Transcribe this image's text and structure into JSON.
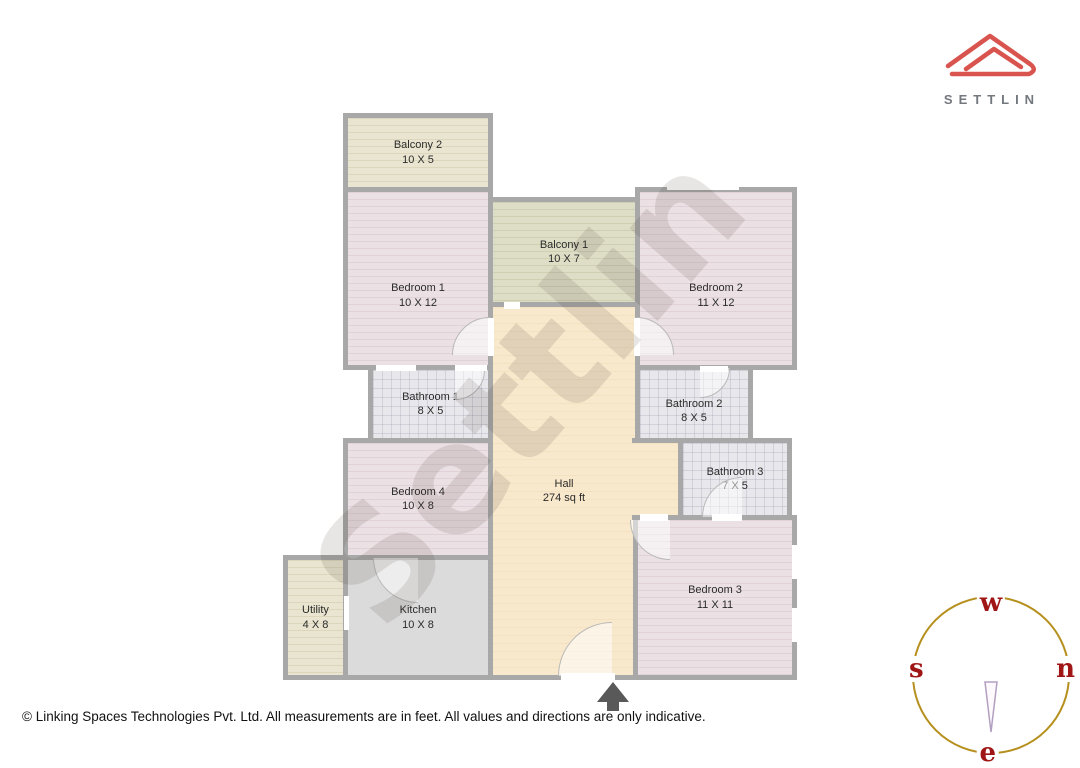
{
  "logo": {
    "brand": "SETTLIN",
    "accent_color": "#d9544e",
    "text_color": "#73787f"
  },
  "watermark": {
    "text": "Settlin"
  },
  "floorplan": {
    "colors": {
      "wall": "#a8a8a8",
      "bedroom_fill": "#ebe0e4",
      "bathroom_fill": "#e8e8ec",
      "hall_fill": "#f8e8cc",
      "kitchen_fill": "#dbdbdb",
      "balcony_fill": "#e9e5d0",
      "balcony1_fill": "#dedec6"
    },
    "rooms": [
      {
        "id": "balcony-2",
        "name": "Balcony 2",
        "dims": "10 X 5",
        "fill": "balcony",
        "rect": [
          343,
          113,
          150,
          79
        ]
      },
      {
        "id": "bedroom-1",
        "name": "Bedroom 1",
        "dims": "10 X 12",
        "fill": "bedroom",
        "rect": [
          343,
          187,
          150,
          183
        ],
        "pad_top": 34
      },
      {
        "id": "balcony-1",
        "name": "Balcony 1",
        "dims": "10 X 7",
        "fill": "balcony2",
        "rect": [
          488,
          197,
          152,
          110
        ]
      },
      {
        "id": "bedroom-2",
        "name": "Bedroom 2",
        "dims": "11 X 12",
        "fill": "bedroom",
        "rect": [
          635,
          187,
          162,
          183
        ],
        "pad_top": 34
      },
      {
        "id": "hall",
        "name": "Hall",
        "dims": "274 sq ft",
        "fill": "hall",
        "rect": [
          488,
          302,
          152,
          378
        ]
      },
      {
        "id": "hall-ext",
        "name": "",
        "dims": "",
        "fill": "hall",
        "rect": [
          632,
          438,
          51,
          82
        ],
        "sides": "tb"
      },
      {
        "id": "bathroom-1",
        "name": "Bathroom 1",
        "dims": "8 X 5",
        "fill": "bath",
        "rect": [
          368,
          365,
          125,
          78
        ]
      },
      {
        "id": "bathroom-2",
        "name": "Bathroom 2",
        "dims": "8 X 5",
        "fill": "bath",
        "rect": [
          635,
          365,
          118,
          78
        ],
        "pad_top": 14
      },
      {
        "id": "bathroom-3",
        "name": "Bathroom 3",
        "dims": "7 X 5",
        "fill": "bath",
        "rect": [
          678,
          438,
          114,
          82
        ]
      },
      {
        "id": "bedroom-4",
        "name": "Bedroom 4",
        "dims": "10 X 8",
        "fill": "bedroom",
        "rect": [
          343,
          438,
          150,
          122
        ]
      },
      {
        "id": "utility",
        "name": "Utility",
        "dims": "4 X 8",
        "fill": "balcony",
        "rect": [
          283,
          555,
          65,
          125
        ]
      },
      {
        "id": "kitchen",
        "name": "Kitchen",
        "dims": "10 X 8",
        "fill": "kitchen",
        "rect": [
          343,
          555,
          150,
          125
        ]
      },
      {
        "id": "bedroom-3",
        "name": "Bedroom 3",
        "dims": "11 X 11",
        "fill": "bedroom",
        "rect": [
          633,
          515,
          164,
          165
        ]
      }
    ],
    "openings": [
      [
        376,
        365,
        40,
        6
      ],
      [
        455,
        365,
        32,
        6
      ],
      [
        667,
        184,
        72,
        6
      ],
      [
        700,
        366,
        28,
        6
      ],
      [
        504,
        302,
        16,
        7
      ],
      [
        344,
        596,
        5,
        34
      ],
      [
        561,
        673,
        54,
        8
      ],
      [
        792,
        545,
        5,
        34
      ],
      [
        792,
        608,
        5,
        34
      ],
      [
        488,
        318,
        6,
        38
      ],
      [
        634,
        318,
        6,
        38
      ],
      [
        712,
        514,
        30,
        7
      ],
      [
        640,
        514,
        28,
        7
      ]
    ],
    "doors": [
      {
        "box": [
          452,
          317,
          76
        ],
        "quad": "tl"
      },
      {
        "box": [
          598,
          317,
          76
        ],
        "quad": "tr"
      },
      {
        "box": [
          425,
          340,
          60
        ],
        "quad": "br"
      },
      {
        "box": [
          670,
          338,
          60
        ],
        "quad": "br"
      },
      {
        "box": [
          702,
          477,
          80
        ],
        "quad": "tl"
      },
      {
        "box": [
          630,
          480,
          80
        ],
        "quad": "bl"
      },
      {
        "box": [
          373,
          513,
          90
        ],
        "quad": "bl"
      },
      {
        "box": [
          558,
          622,
          108
        ],
        "quad": "tl"
      }
    ]
  },
  "compass": {
    "top": "w",
    "left": "s",
    "right": "n",
    "bottom": "e",
    "ring_color": "#b6901e",
    "letter_color": "#a01616"
  },
  "footer": {
    "copyright": "© Linking Spaces Technologies Pvt. Ltd. All measurements are in feet. All values and directions are only indicative."
  }
}
